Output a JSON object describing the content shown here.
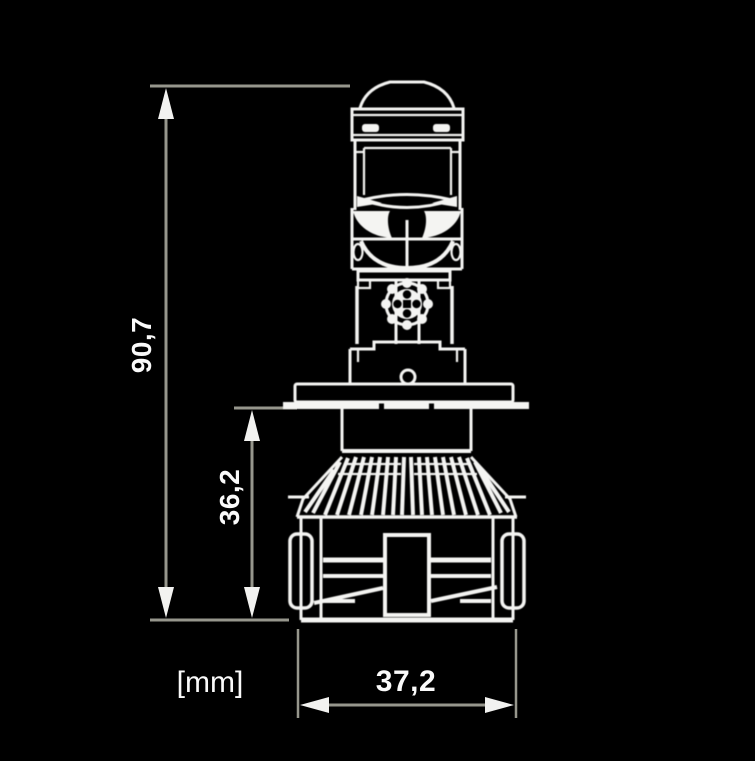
{
  "diagram": {
    "unit_label": "[mm]",
    "dimensions": {
      "overall_height": "90,7",
      "lower_height": "36,2",
      "width": "37,2"
    },
    "colors": {
      "background": "#000000",
      "dimension_line": "#96968c",
      "drawing_line": "#f4f4f2",
      "text": "#fafafa"
    }
  }
}
